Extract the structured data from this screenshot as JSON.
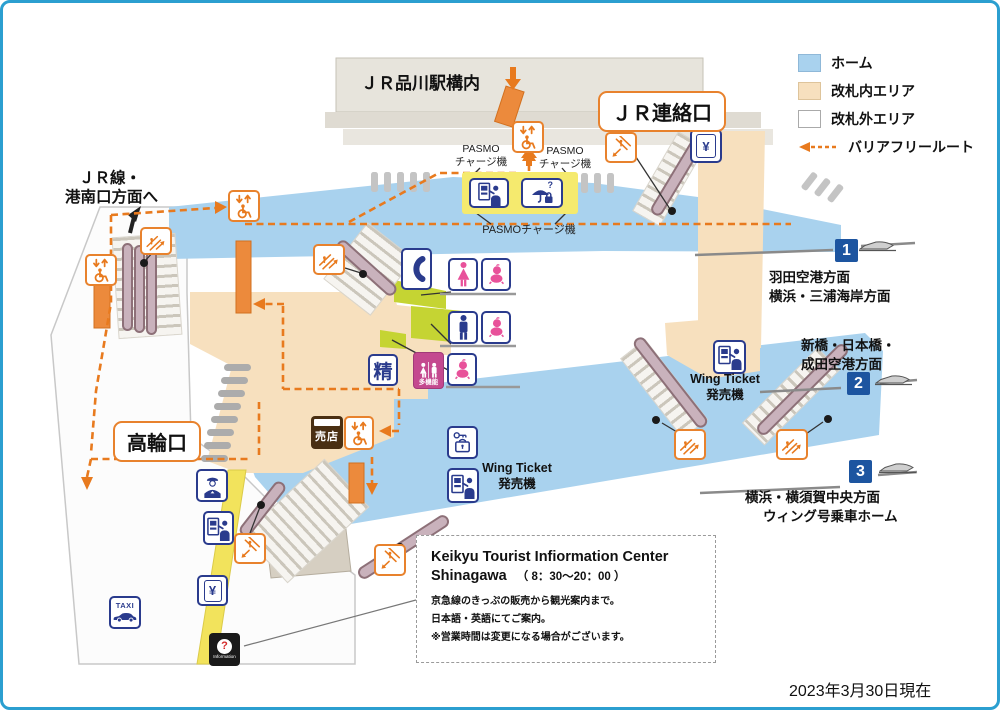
{
  "legend": {
    "items": [
      {
        "label": "ホーム",
        "color": "#A9D2EE"
      },
      {
        "label": "改札内エリア",
        "color": "#F7E0BE"
      },
      {
        "label": "改札外エリア",
        "color": "#FFFFFF"
      },
      {
        "label": "バリアフリールート",
        "color": "#E87A1E"
      }
    ]
  },
  "titles": {
    "jr_station_area": "ＪＲ品川駅構内",
    "jr_transfer_gate": "ＪＲ連絡口",
    "takanawa_gate": "高輪口",
    "konan_line1": "ＪＲ線・",
    "konan_line2": "港南口方面へ"
  },
  "labels": {
    "pasmo_line1": "PASMO",
    "pasmo_line2": "チャージ機",
    "pasmo_bottom": "PASMOチャージ機",
    "wing_line1": "Wing Ticket",
    "wing_line2": "発売機"
  },
  "platforms": [
    {
      "num": "1",
      "dest_line1": "羽田空港方面",
      "dest_line2": "横浜・三浦海岸方面"
    },
    {
      "num": "2",
      "dest_line1": "新橋・日本橋・",
      "dest_line2": "成田空港方面"
    },
    {
      "num": "3",
      "dest_line1": "横浜・横須賀中央方面",
      "dest_line2": "ウィング号乗車ホーム"
    }
  ],
  "info_center": {
    "title": "Keikyu Tourist Infiormation Center",
    "subtitle": "Shinagawa",
    "hours": "（ 8：30～20：00 ）",
    "body_line1": "京急線のきっぷの販売から観光案内まで。",
    "body_line2": "日本語・英語にてご案内。",
    "body_line3": "※営業時間は変更になる場合がございます。"
  },
  "footer": {
    "date_note": "2023年3月30日現在"
  },
  "icon_texts": {
    "fare_adjustment": "精",
    "kiosk": "売店",
    "taxi": "TAXI",
    "yen": "¥",
    "question_mark": "?",
    "information": "Information",
    "multi_function": "多機能"
  },
  "icons": {
    "elevator-icon": "wheelchair with up/down arrows, orange",
    "escalator-up-icon": "escalator with up-right arrow, orange",
    "escalator-down-icon": "escalator with down-left arrow, orange",
    "phone-icon": "telephone handset, navy",
    "restroom-women-icon": "woman figure, pink",
    "restroom-men-icon": "man figure, navy",
    "baby-icon": "baby figure, pink",
    "multi-function-restroom-icon": "man and woman on magenta",
    "ticket-machine-icon": "vending machine with person, navy",
    "yen-machine-icon": "machine with yen sign, navy",
    "coin-locker-icon": "key and locker, navy",
    "lost-and-found-icon": "umbrella, bag and question mark, navy",
    "station-staff-icon": "station staff figure, navy",
    "taxi-icon": "TAXI letters with car, navy",
    "information-icon": "red question mark on black",
    "kiosk-icon": "brown shop sign",
    "train-icon": "train side silhouette, grey"
  },
  "colors": {
    "border_blue": "#2B9FD0",
    "platform_blue": "#A9D2EE",
    "paid_area": "#F7E0BE",
    "unpaid_area": "#FFFFFF",
    "route_orange": "#E87A1E",
    "icon_navy": "#2A3B8D",
    "pink": "#E8519A",
    "magenta": "#C4498F",
    "gate_yellow": "#F2E35C",
    "pasmo_yellow": "#F5EA6E",
    "restroom_green": "#C5D433",
    "escalator_mauve": "#C9B2BC",
    "badge_blue": "#1D55A0",
    "jr_building_grey": "#E7E4DC"
  }
}
